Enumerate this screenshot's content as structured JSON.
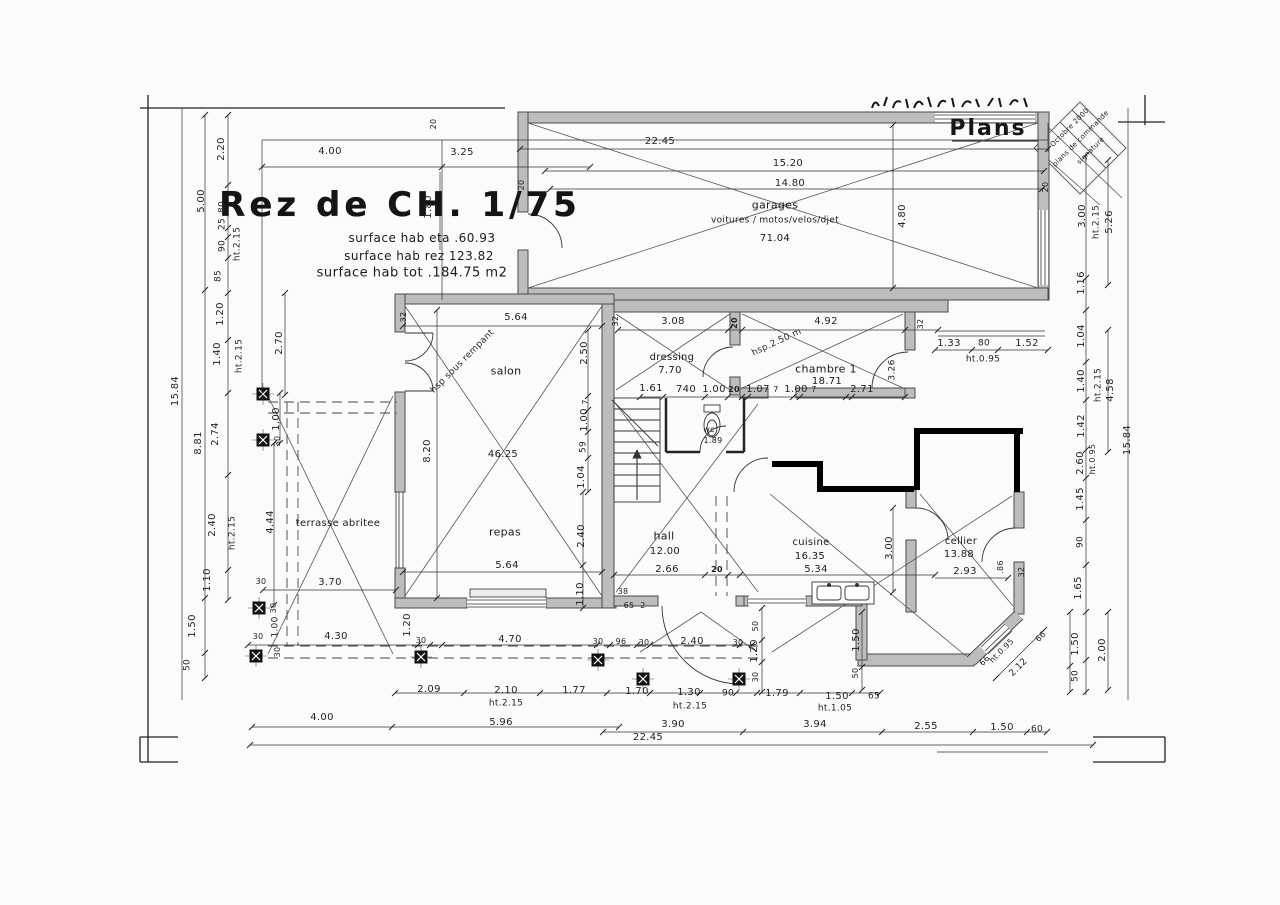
{
  "colors": {
    "paper": "#fbfbf9",
    "ink": "#1f1f1f",
    "wall_fill": "#bdbdbd",
    "new_wall": "#000000"
  },
  "annotations": {
    "title_block": {
      "items": [
        {
          "t": "Rez de CH. 1/75",
          "x": 400,
          "y": 205,
          "s": 34,
          "b": 1,
          "cls": "plan-title"
        },
        {
          "t": "surface hab eta .60.93",
          "x": 422,
          "y": 238,
          "s": 12,
          "cls": "surface-note"
        },
        {
          "t": "surface hab rez 123.82",
          "x": 419,
          "y": 256,
          "s": 12,
          "cls": "surface-note"
        },
        {
          "t": "surface hab tot .184.75 m2",
          "x": 412,
          "y": 273,
          "s": 13,
          "cls": "surface-note"
        }
      ]
    },
    "sheet": {
      "items": [
        {
          "t": "Plans",
          "x": 988,
          "y": 129,
          "s": 22,
          "cls": "sheet-plans"
        }
      ]
    },
    "stamp": {
      "items": [
        {
          "t": "Octobre 2000",
          "x": 1070,
          "y": 128,
          "r": -45,
          "s": 7
        },
        {
          "t": "plans de commande",
          "x": 1081,
          "y": 139,
          "r": -45,
          "s": 7
        },
        {
          "t": "signature",
          "x": 1091,
          "y": 151,
          "r": -45,
          "s": 7
        }
      ]
    },
    "rooms": {
      "items": [
        {
          "t": "garages",
          "x": 775,
          "y": 205,
          "s": 11
        },
        {
          "t": "voitures / motos/velos/djet",
          "x": 775,
          "y": 221,
          "s": 9
        },
        {
          "t": "71.04",
          "x": 775,
          "y": 239,
          "s": 10
        },
        {
          "t": "salon",
          "x": 506,
          "y": 371,
          "s": 11
        },
        {
          "t": "46.25",
          "x": 503,
          "y": 455,
          "s": 10
        },
        {
          "t": "repas",
          "x": 505,
          "y": 532,
          "s": 11
        },
        {
          "t": "dressing",
          "x": 672,
          "y": 358,
          "s": 10
        },
        {
          "t": "7.70",
          "x": 670,
          "y": 371,
          "s": 10
        },
        {
          "t": "chambre 1",
          "x": 826,
          "y": 369,
          "s": 11
        },
        {
          "t": "18.71",
          "x": 827,
          "y": 382,
          "s": 10
        },
        {
          "t": "hall",
          "x": 664,
          "y": 536,
          "s": 11
        },
        {
          "t": "12.00",
          "x": 665,
          "y": 552,
          "s": 10
        },
        {
          "t": "2.66",
          "x": 667,
          "y": 570,
          "s": 10
        },
        {
          "t": "cuisine",
          "x": 811,
          "y": 543,
          "s": 10
        },
        {
          "t": "16.35",
          "x": 810,
          "y": 557,
          "s": 10
        },
        {
          "t": "cellier",
          "x": 961,
          "y": 542,
          "s": 10
        },
        {
          "t": "13.88",
          "x": 959,
          "y": 555,
          "s": 10
        },
        {
          "t": "wc",
          "x": 709,
          "y": 430,
          "s": 8
        },
        {
          "t": "1.89",
          "x": 713,
          "y": 441,
          "s": 8
        },
        {
          "t": "terrasse abritee",
          "x": 338,
          "y": 524,
          "s": 10
        }
      ]
    },
    "slopes": {
      "items": [
        {
          "t": "hsp sous rempant",
          "x": 463,
          "y": 362,
          "r": -45,
          "s": 9
        },
        {
          "t": "hsp.2.50 m",
          "x": 777,
          "y": 343,
          "r": -25,
          "s": 9
        }
      ]
    },
    "dims": {
      "items": [
        {
          "t": "22.45",
          "x": 660,
          "y": 142
        },
        {
          "t": "15.20",
          "x": 788,
          "y": 164
        },
        {
          "t": "14.80",
          "x": 790,
          "y": 184
        },
        {
          "t": "4.00",
          "x": 330,
          "y": 152
        },
        {
          "t": "3.25",
          "x": 462,
          "y": 153
        },
        {
          "t": "20",
          "x": 434,
          "y": 124,
          "r": -90,
          "s": 8
        },
        {
          "t": "1.80",
          "x": 429,
          "y": 207,
          "r": -90
        },
        {
          "t": "20",
          "x": 522,
          "y": 185,
          "r": -90,
          "s": 8
        },
        {
          "t": "4.80",
          "x": 903,
          "y": 216,
          "r": -90
        },
        {
          "t": "20",
          "x": 1046,
          "y": 187,
          "r": -90,
          "s": 8
        },
        {
          "t": "3.08",
          "x": 673,
          "y": 322
        },
        {
          "t": "20",
          "x": 735,
          "y": 323,
          "r": -90,
          "s": 8,
          "b": 1
        },
        {
          "t": "4.92",
          "x": 826,
          "y": 322
        },
        {
          "t": "32",
          "x": 921,
          "y": 324,
          "r": -90,
          "s": 8
        },
        {
          "t": "32",
          "x": 404,
          "y": 317,
          "r": -90,
          "s": 8
        },
        {
          "t": "32",
          "x": 616,
          "y": 321,
          "r": -90,
          "s": 8
        },
        {
          "t": "5.64",
          "x": 516,
          "y": 318
        },
        {
          "t": "2.20",
          "x": 222,
          "y": 149,
          "r": -90
        },
        {
          "t": "5.00",
          "x": 202,
          "y": 201,
          "r": -90
        },
        {
          "t": "80",
          "x": 223,
          "y": 207,
          "r": -90,
          "s": 9
        },
        {
          "t": "25",
          "x": 223,
          "y": 224,
          "r": -90,
          "s": 9
        },
        {
          "t": "90",
          "x": 223,
          "y": 246,
          "r": -90,
          "s": 9
        },
        {
          "t": "ht.2.15",
          "x": 238,
          "y": 244,
          "r": -90,
          "s": 9
        },
        {
          "t": "85",
          "x": 219,
          "y": 276,
          "r": -90,
          "s": 9
        },
        {
          "t": "1.20",
          "x": 221,
          "y": 314,
          "r": -90
        },
        {
          "t": "1.40",
          "x": 218,
          "y": 354,
          "r": -90
        },
        {
          "t": "ht.2.15",
          "x": 240,
          "y": 356,
          "r": -90,
          "s": 9
        },
        {
          "t": "2.70",
          "x": 280,
          "y": 343,
          "r": -90
        },
        {
          "t": "15.84",
          "x": 176,
          "y": 391,
          "r": -90
        },
        {
          "t": "8.81",
          "x": 199,
          "y": 443,
          "r": -90
        },
        {
          "t": "2.74",
          "x": 216,
          "y": 434,
          "r": -90
        },
        {
          "t": "2.40",
          "x": 213,
          "y": 525,
          "r": -90
        },
        {
          "t": "ht.2.15",
          "x": 233,
          "y": 533,
          "r": -90,
          "s": 9
        },
        {
          "t": "1.10",
          "x": 208,
          "y": 580,
          "r": -90
        },
        {
          "t": "1.50",
          "x": 193,
          "y": 626,
          "r": -90
        },
        {
          "t": "50",
          "x": 188,
          "y": 665,
          "r": -90,
          "s": 9
        },
        {
          "t": "1.00",
          "x": 277,
          "y": 419,
          "r": -90
        },
        {
          "t": "30",
          "x": 278,
          "y": 441,
          "r": -90,
          "s": 8
        },
        {
          "t": "4.44",
          "x": 271,
          "y": 522,
          "r": -90
        },
        {
          "t": "30",
          "x": 261,
          "y": 582,
          "s": 8
        },
        {
          "t": "3.70",
          "x": 330,
          "y": 583
        },
        {
          "t": "8.20",
          "x": 428,
          "y": 451,
          "r": -90
        },
        {
          "t": "2.50",
          "x": 585,
          "y": 353,
          "r": -90
        },
        {
          "t": "7",
          "x": 586,
          "y": 402,
          "r": -90,
          "s": 8
        },
        {
          "t": "1.00",
          "x": 585,
          "y": 420,
          "r": -90
        },
        {
          "t": "59",
          "x": 584,
          "y": 447,
          "r": -90,
          "s": 9
        },
        {
          "t": "1.04",
          "x": 582,
          "y": 477,
          "r": -90
        },
        {
          "t": "2.40",
          "x": 582,
          "y": 536,
          "r": -90
        },
        {
          "t": "1.10",
          "x": 581,
          "y": 594,
          "r": -90
        },
        {
          "t": "5.64",
          "x": 507,
          "y": 566
        },
        {
          "t": "1.61",
          "x": 651,
          "y": 389
        },
        {
          "t": "740",
          "x": 686,
          "y": 390
        },
        {
          "t": "1.00",
          "x": 714,
          "y": 390
        },
        {
          "t": "20",
          "x": 734,
          "y": 390,
          "s": 8,
          "b": 1
        },
        {
          "t": "1.07",
          "x": 758,
          "y": 390
        },
        {
          "t": "7",
          "x": 776,
          "y": 390,
          "s": 8
        },
        {
          "t": "1.00",
          "x": 796,
          "y": 390
        },
        {
          "t": "7",
          "x": 814,
          "y": 390,
          "s": 8
        },
        {
          "t": "2.71",
          "x": 862,
          "y": 390
        },
        {
          "t": "3.26",
          "x": 893,
          "y": 370,
          "r": -90,
          "s": 9
        },
        {
          "t": "1.33",
          "x": 949,
          "y": 344
        },
        {
          "t": "80",
          "x": 984,
          "y": 344,
          "s": 9
        },
        {
          "t": "1.52",
          "x": 1027,
          "y": 344
        },
        {
          "t": "ht.0.95",
          "x": 983,
          "y": 360,
          "s": 9
        },
        {
          "t": "20",
          "x": 717,
          "y": 570,
          "s": 8,
          "b": 1
        },
        {
          "t": "5.34",
          "x": 816,
          "y": 570
        },
        {
          "t": "3.00",
          "x": 890,
          "y": 548,
          "r": -90
        },
        {
          "t": "2.93",
          "x": 965,
          "y": 572
        },
        {
          "t": ".86",
          "x": 1001,
          "y": 567,
          "r": -90,
          "s": 8
        },
        {
          "t": "32",
          "x": 1022,
          "y": 572,
          "r": -90,
          "s": 8
        },
        {
          "t": "3.00",
          "x": 1083,
          "y": 216,
          "r": -90
        },
        {
          "t": "ht.2.15",
          "x": 1097,
          "y": 222,
          "r": -90,
          "s": 9
        },
        {
          "t": "5.26",
          "x": 1110,
          "y": 222,
          "r": -90
        },
        {
          "t": "1.16",
          "x": 1082,
          "y": 283,
          "r": -90
        },
        {
          "t": "1.04",
          "x": 1082,
          "y": 336,
          "r": -90
        },
        {
          "t": "1.40",
          "x": 1082,
          "y": 381,
          "r": -90
        },
        {
          "t": "ht.2.15",
          "x": 1099,
          "y": 385,
          "r": -90,
          "s": 9
        },
        {
          "t": "4.58",
          "x": 1111,
          "y": 390,
          "r": -90
        },
        {
          "t": "1.42",
          "x": 1082,
          "y": 426,
          "r": -90
        },
        {
          "t": "2.60",
          "x": 1081,
          "y": 463,
          "r": -90
        },
        {
          "t": "ht.0.95",
          "x": 1093,
          "y": 459,
          "r": -90,
          "s": 8
        },
        {
          "t": "15.84",
          "x": 1128,
          "y": 440,
          "r": -90
        },
        {
          "t": "1.45",
          "x": 1081,
          "y": 499,
          "r": -90
        },
        {
          "t": "90",
          "x": 1081,
          "y": 542,
          "r": -90,
          "s": 9
        },
        {
          "t": "1.65",
          "x": 1079,
          "y": 588,
          "r": -90
        },
        {
          "t": "1.50",
          "x": 1076,
          "y": 644,
          "r": -90
        },
        {
          "t": "50",
          "x": 1076,
          "y": 676,
          "r": -90,
          "s": 9
        },
        {
          "t": "2.00",
          "x": 1103,
          "y": 650,
          "r": -90
        },
        {
          "t": "30",
          "x": 274,
          "y": 608,
          "r": -90,
          "s": 8
        },
        {
          "t": "1.00",
          "x": 276,
          "y": 627,
          "r": -90,
          "s": 9
        },
        {
          "t": "30",
          "x": 258,
          "y": 637,
          "s": 8
        },
        {
          "t": "30",
          "x": 278,
          "y": 652,
          "r": -90,
          "s": 8
        },
        {
          "t": "4.30",
          "x": 336,
          "y": 637
        },
        {
          "t": "1.20",
          "x": 408,
          "y": 625,
          "r": -90
        },
        {
          "t": "30",
          "x": 421,
          "y": 641,
          "s": 8
        },
        {
          "t": "4.70",
          "x": 510,
          "y": 640
        },
        {
          "t": "30",
          "x": 598,
          "y": 642,
          "s": 8
        },
        {
          "t": "96",
          "x": 621,
          "y": 642,
          "s": 8
        },
        {
          "t": "30",
          "x": 644,
          "y": 643,
          "s": 8
        },
        {
          "t": "2.40",
          "x": 692,
          "y": 642
        },
        {
          "t": "30",
          "x": 738,
          "y": 643,
          "s": 8
        },
        {
          "t": "50",
          "x": 756,
          "y": 626,
          "r": -90,
          "s": 8
        },
        {
          "t": "1.20",
          "x": 755,
          "y": 651,
          "r": -90
        },
        {
          "t": "30",
          "x": 756,
          "y": 677,
          "r": -90,
          "s": 8
        },
        {
          "t": "38",
          "x": 623,
          "y": 592,
          "s": 8
        },
        {
          "t": "65",
          "x": 629,
          "y": 606,
          "s": 8
        },
        {
          "t": "2",
          "x": 643,
          "y": 606,
          "s": 8
        },
        {
          "t": "1.50",
          "x": 857,
          "y": 640,
          "r": -90
        },
        {
          "t": "50",
          "x": 856,
          "y": 673,
          "r": -90,
          "s": 8
        },
        {
          "t": "2.09",
          "x": 429,
          "y": 690
        },
        {
          "t": "2.10",
          "x": 506,
          "y": 691
        },
        {
          "t": "1.77",
          "x": 574,
          "y": 691
        },
        {
          "t": "ht.2.15",
          "x": 506,
          "y": 704,
          "s": 9
        },
        {
          "t": "1.70",
          "x": 637,
          "y": 692
        },
        {
          "t": "1.30",
          "x": 689,
          "y": 693
        },
        {
          "t": "90",
          "x": 728,
          "y": 694,
          "s": 9
        },
        {
          "t": "ht.2.15",
          "x": 690,
          "y": 707,
          "s": 9
        },
        {
          "t": "1.79",
          "x": 777,
          "y": 694
        },
        {
          "t": "1.50",
          "x": 837,
          "y": 697
        },
        {
          "t": "65",
          "x": 874,
          "y": 697,
          "s": 9
        },
        {
          "t": "ht.1.05",
          "x": 835,
          "y": 709,
          "s": 9
        },
        {
          "t": "4.00",
          "x": 322,
          "y": 718
        },
        {
          "t": "5.96",
          "x": 501,
          "y": 723
        },
        {
          "t": "3.90",
          "x": 673,
          "y": 725
        },
        {
          "t": "3.94",
          "x": 815,
          "y": 725
        },
        {
          "t": "2.55",
          "x": 926,
          "y": 727
        },
        {
          "t": "1.50",
          "x": 1002,
          "y": 728
        },
        {
          "t": "60",
          "x": 1037,
          "y": 730,
          "s": 9
        },
        {
          "t": "22.45",
          "x": 648,
          "y": 738
        },
        {
          "t": "66",
          "x": 1041,
          "y": 637,
          "r": -45,
          "s": 8
        },
        {
          "t": "ht.0.95",
          "x": 1002,
          "y": 651,
          "r": -45,
          "s": 8
        },
        {
          "t": "66",
          "x": 985,
          "y": 661,
          "r": -45,
          "s": 8
        },
        {
          "t": "2.12",
          "x": 1019,
          "y": 668,
          "r": -45,
          "s": 9
        }
      ]
    }
  }
}
